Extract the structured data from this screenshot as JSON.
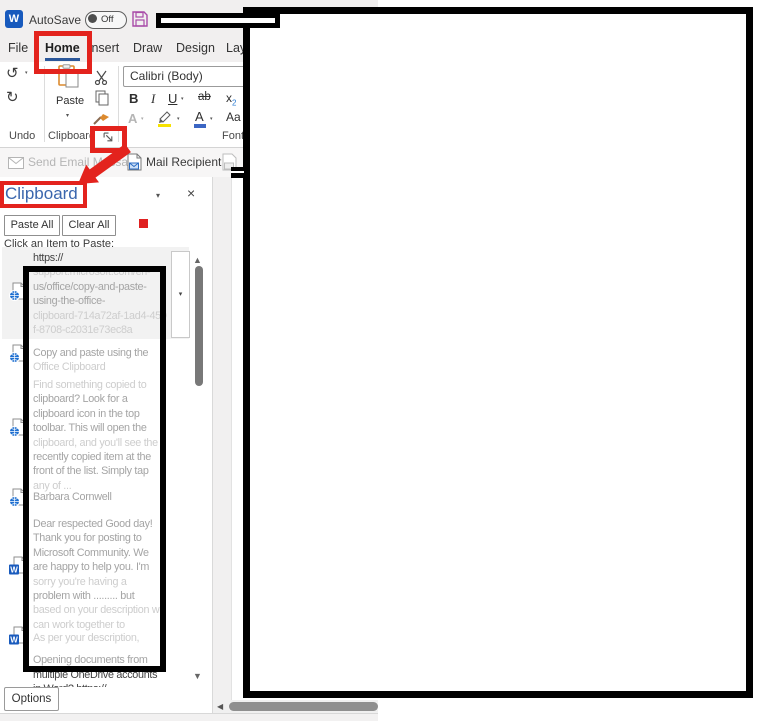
{
  "titlebar": {
    "autosave": "AutoSave",
    "autosave_state": "Off"
  },
  "tabs": [
    {
      "label": "File"
    },
    {
      "label": "Home",
      "active": true
    },
    {
      "label": "Insert"
    },
    {
      "label": "Draw"
    },
    {
      "label": "Design"
    },
    {
      "label": "Layout"
    }
  ],
  "ribbon": {
    "groups": {
      "undo": "Undo",
      "clipboard": "Clipboard",
      "font": "Font"
    },
    "paste_label": "Paste",
    "font_name": "Calibri (Body)",
    "bold": "B",
    "italic": "I",
    "underline": "U",
    "strike": "ab",
    "subscript_base": "x",
    "subscript_small": "2",
    "text_effects": "A",
    "font_color": "A",
    "change_case": "Aa"
  },
  "toolbar": {
    "send_email": "Send Email Message",
    "mail_recipient": "Mail Recipient"
  },
  "pane": {
    "title": "Clipboard",
    "paste_all": "Paste All",
    "clear_all": "Clear All",
    "hint": "Click an Item to Paste:",
    "options": "Options",
    "items": [
      {
        "icon": "web",
        "lines": [
          [
            "https://",
            "d"
          ],
          [
            "support.microsoft.com/en-",
            "l"
          ],
          [
            "us/office/copy-and-paste-",
            "m"
          ],
          [
            "using-the-office-",
            "m"
          ],
          [
            "clipboard-714a72af-1ad4-450",
            "l"
          ],
          [
            "f-8708-c2031e73ec8a",
            "l"
          ]
        ]
      },
      {
        "icon": "web",
        "lines": [
          [
            "Copy and paste using the",
            "m"
          ],
          [
            "Office Clipboard",
            "l"
          ]
        ]
      },
      {
        "icon": "web",
        "lines": [
          [
            "Find something copied to",
            "l"
          ],
          [
            "clipboard? Look for a",
            "m"
          ],
          [
            "clipboard icon in the top",
            "m"
          ],
          [
            "toolbar. This will open the",
            "m"
          ],
          [
            "clipboard, and you'll see the",
            "l"
          ],
          [
            "recently copied item at the",
            "m"
          ],
          [
            "front of the list. Simply tap",
            "m"
          ],
          [
            "any of ...",
            "l"
          ]
        ]
      },
      {
        "icon": "web",
        "lines": [
          [
            "Barbara Cornwell",
            "m"
          ]
        ]
      },
      {
        "icon": "word",
        "lines": [
          [
            "Dear respected Good day!",
            "m"
          ],
          [
            "Thank you for posting to",
            "m"
          ],
          [
            "Microsoft Community. We",
            "m"
          ],
          [
            "are happy to help you. I'm",
            "m"
          ],
          [
            "sorry you're having a",
            "l"
          ],
          [
            "problem with ......... but",
            "m"
          ],
          [
            "based on your description we",
            "l"
          ],
          [
            "can work together to",
            "l"
          ]
        ]
      },
      {
        "icon": "word",
        "lines": [
          [
            "As per your description,",
            "l"
          ],
          [
            "",
            "l"
          ],
          [
            "Opening documents from",
            "m"
          ],
          [
            "multiple OneDrive accounts",
            "d"
          ],
          [
            "in Word? https://...",
            "d"
          ]
        ]
      }
    ]
  },
  "colors": {
    "annotation_red": "#e3231d",
    "accent_blue": "#2b579a",
    "pane_title_blue": "#3a66ad",
    "word_blue": "#185abd",
    "globe_blue": "#1e6fd0",
    "highlight_yellow": "#f7e200",
    "font_color_blue": "#3b66c4",
    "paste_orange": "#dc8a2e",
    "save_purple": "#a84ba8"
  }
}
